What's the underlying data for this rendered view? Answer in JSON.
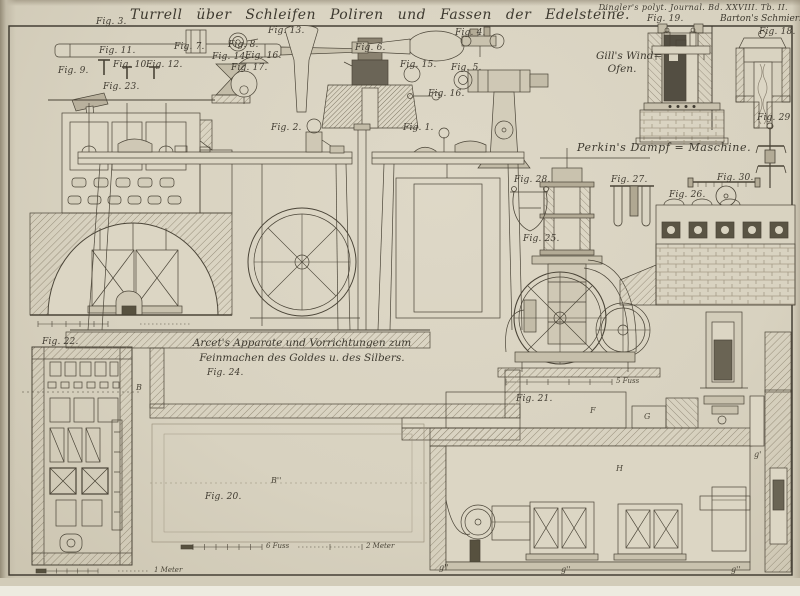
{
  "plate": {
    "journal_ref": "Dingler's polyt. Journal. Bd. XXVIII. Tb. II.",
    "title": "Turrell über Schleifen Poliren und Fassen der Edelsteine.",
    "sections": {
      "gill_line1": "Gill's Wind=",
      "gill_line2": "Ofen.",
      "barton": "Barton's Schmierbüchsen.",
      "perkin": "Perkin's Dampf = Maschine.",
      "arcet_line1": "Arcet's Apparate und Vorrichtungen zum",
      "arcet_line2": "Feinmachen des Goldes u. des Silbers."
    }
  },
  "figures": [
    {
      "label": "Fig. 3."
    },
    {
      "label": "Fig. 9."
    },
    {
      "label": "Fig. 11."
    },
    {
      "label": "Fig. 10."
    },
    {
      "label": "Fig. 12."
    },
    {
      "label": "Fig. 14."
    },
    {
      "label": "Fig. 7."
    },
    {
      "label": "Fig. 8."
    },
    {
      "label": "Fig. 16."
    },
    {
      "label": "Fig. 13."
    },
    {
      "label": "Fig. 17."
    },
    {
      "label": "Fig. 23."
    },
    {
      "label": "Fig. 6."
    },
    {
      "label": "Fig. 4."
    },
    {
      "label": "Fig. 5."
    },
    {
      "label": "Fig. 15."
    },
    {
      "label": "Fig. 16."
    },
    {
      "label": "Fig. 1."
    },
    {
      "label": "Fig. 2."
    },
    {
      "label": "Fig. 19."
    },
    {
      "label": "Fig. 18."
    },
    {
      "label": "Fig. 29."
    },
    {
      "label": "Fig. 28."
    },
    {
      "label": "Fig. 27."
    },
    {
      "label": "Fig. 30."
    },
    {
      "label": "Fig. 26."
    },
    {
      "label": "Fig. 25."
    },
    {
      "label": "Fig. 22."
    },
    {
      "label": "Fig. 24."
    },
    {
      "label": "Fig. 20."
    },
    {
      "label": "Fig. 21."
    }
  ],
  "scales": {
    "fuss6": "6 Fuss",
    "meter2": "2 Meter",
    "fuss5": "5 Fuss",
    "meter1": "1 Meter"
  },
  "annotations": [
    {
      "text": "F"
    },
    {
      "text": "G"
    },
    {
      "text": "H"
    },
    {
      "text": "B''"
    },
    {
      "text": "B"
    },
    {
      "text": "g'"
    },
    {
      "text": "g''"
    },
    {
      "text": "g''"
    },
    {
      "text": "g''"
    }
  ]
}
